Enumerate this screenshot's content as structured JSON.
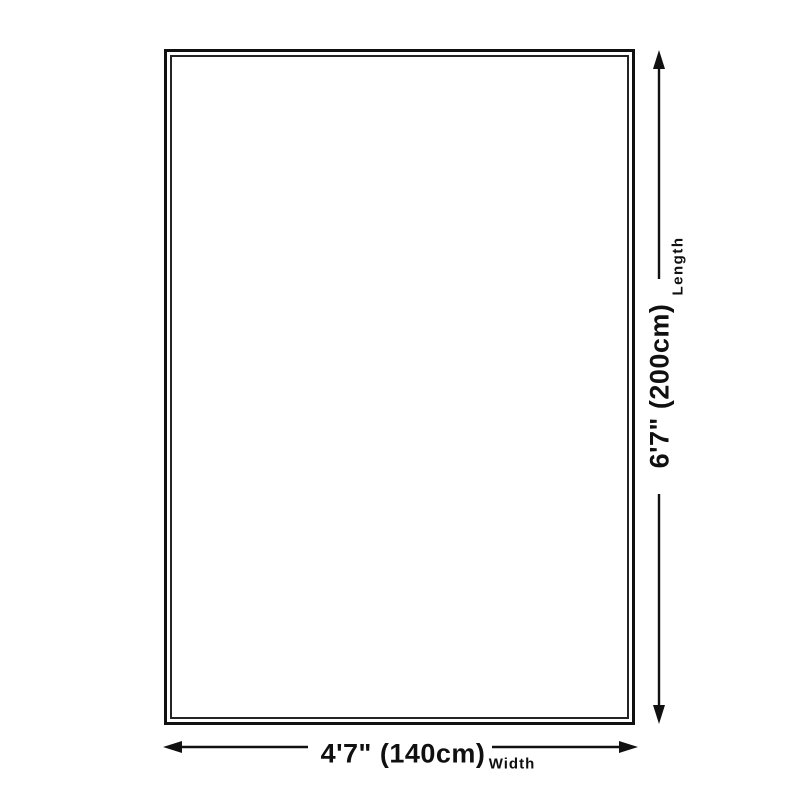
{
  "diagram": {
    "type": "product-dimension-diagram",
    "shape": "rectangle",
    "length": {
      "value": "6'7\" (200cm)",
      "label": "Length"
    },
    "width": {
      "value": "4'7\" (140cm)",
      "label": "Width"
    }
  },
  "colors": {
    "background": "#ffffff",
    "outline": "#101010",
    "line": "#111111",
    "text": "#101010"
  }
}
